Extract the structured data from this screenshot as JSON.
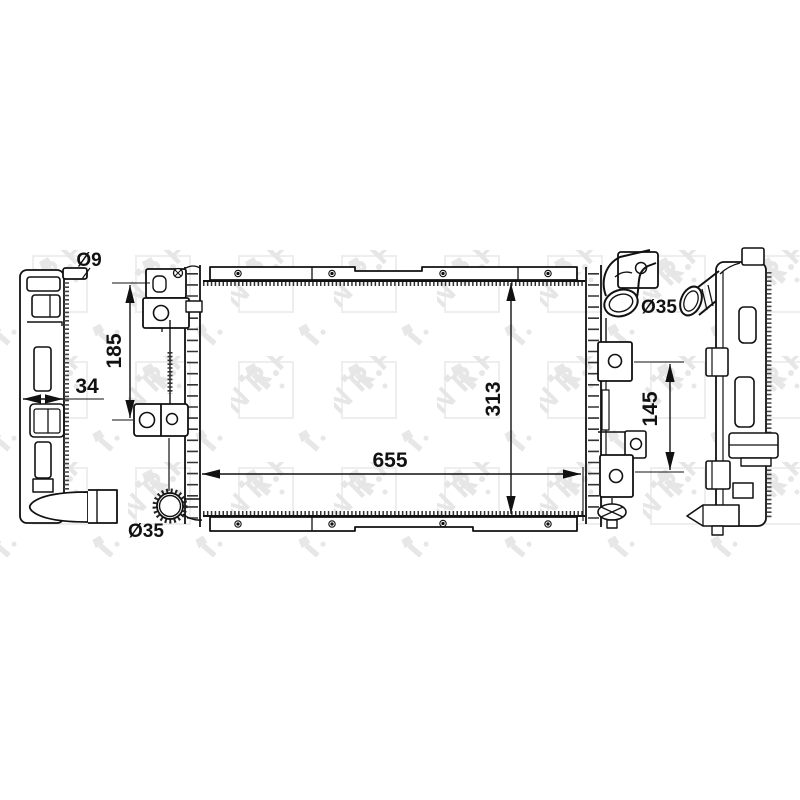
{
  "watermark": {
    "text": "NRF"
  },
  "labels": {
    "pin_diameter": "Ø9",
    "side_depth": "34",
    "left_mount_spacing": "185",
    "core_width": "655",
    "core_height": "313",
    "right_mount_spacing": "145",
    "top_port_diameter": "Ø35",
    "bottom_port_diameter": "Ø35"
  }
}
